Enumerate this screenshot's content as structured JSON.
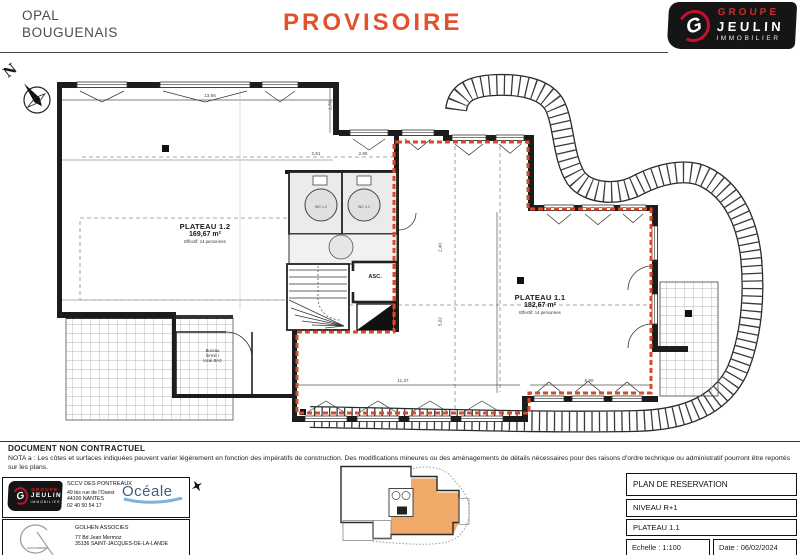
{
  "header": {
    "title1": "OPAL",
    "title2": "BOUGUENAIS",
    "watermark": "PROVISOIRE",
    "logo": {
      "letter": "G",
      "line1": "GROUPE",
      "line2": "JEULIN",
      "line3": "IMMOBILIER"
    },
    "colors": {
      "watermark": "#e2512b",
      "brand_red": "#c8102e"
    }
  },
  "plan": {
    "north": "N",
    "plateau_12": {
      "name": "PLATEAU 1.2",
      "area": "169,67 m²",
      "occupancy": "Effectif: 14 personnes"
    },
    "plateau_11": {
      "name": "PLATEAU 1.1",
      "area": "182,67 m²",
      "occupancy": "Effectif: 14 personnes"
    },
    "wc12": "WC 1.2",
    "wc11": "WC 1.1",
    "elevator": "ASC.",
    "office": {
      "l1": "Bureau",
      "l2": "fermé /",
      "l3": "local BA3"
    },
    "dims": {
      "d1": "13,66",
      "d2": "2,73",
      "d3": "2,61",
      "d4": "2,90",
      "d5": "11,37",
      "d6": "6,90",
      "d7": "2,40",
      "d8": "5,02"
    },
    "boundary_color": "#d84a2b"
  },
  "notes": {
    "title": "DOCUMENT NON CONTRACTUEL",
    "nota": "NOTA a : Les côtes et surfaces indiquées peuvent varier légèrement en fonction des impératifs de construction. Des modifications mineures ou des aménagements de détails nécessaires pour des raisons d'ordre technique ou administratif pourront être reportés sur les plans."
  },
  "footer": {
    "company1": {
      "name": "SCCV DES PONTREAUX",
      "addr1": "49 bis rue de l'Ouest",
      "addr2": "44100 NANTES",
      "phone": "02 40 50 54 17"
    },
    "oceale": "Océale",
    "company2": {
      "name": "GOLHEN ASSOCIES",
      "addr1": "77 Bd Jean Mermoz",
      "addr2": "35136 SAINT-JACQUES-DE-LA-LANDE"
    },
    "titleblock": {
      "row1": "PLAN DE RESERVATION",
      "row2": "NIVEAU R+1",
      "row3": "PLATEAU 1.1",
      "scale": "Echelle : 1:100",
      "date": "Date : 06/02/2024"
    }
  }
}
